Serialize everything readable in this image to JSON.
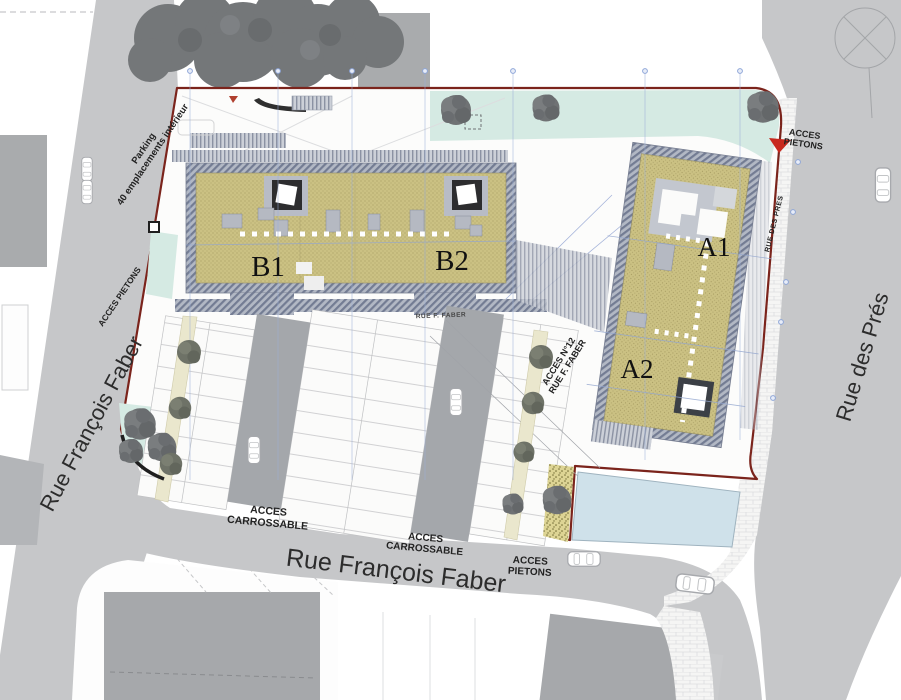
{
  "title": "Plan de situation - résidences A et B",
  "colors": {
    "parcel_boundary": "#7b241c",
    "roof_khaki": "#cbc183",
    "green_strip": "#d5eae3",
    "water_basin": "#cfe1ea",
    "street_gray": "#c6c7c9",
    "access_marker_red": "#c8281e"
  },
  "streets": {
    "faber": "Rue François Faber",
    "pres": "Rue des Prés",
    "pres_small": "RUE DES PRES",
    "faber_small": "RUE F. FABER"
  },
  "buildings": {
    "b1": "B1",
    "b2": "B2",
    "a1": "A1",
    "a2": "A2"
  },
  "access": {
    "acces": "ACCES",
    "pietons": "PIETONS",
    "carrossable": "CARROSSABLE",
    "acces_pietons": "ACCES PIETONS",
    "n12": "ACCES N°12"
  },
  "parking": {
    "line1": "Parking",
    "line2": "40 emplacements intérieur"
  }
}
